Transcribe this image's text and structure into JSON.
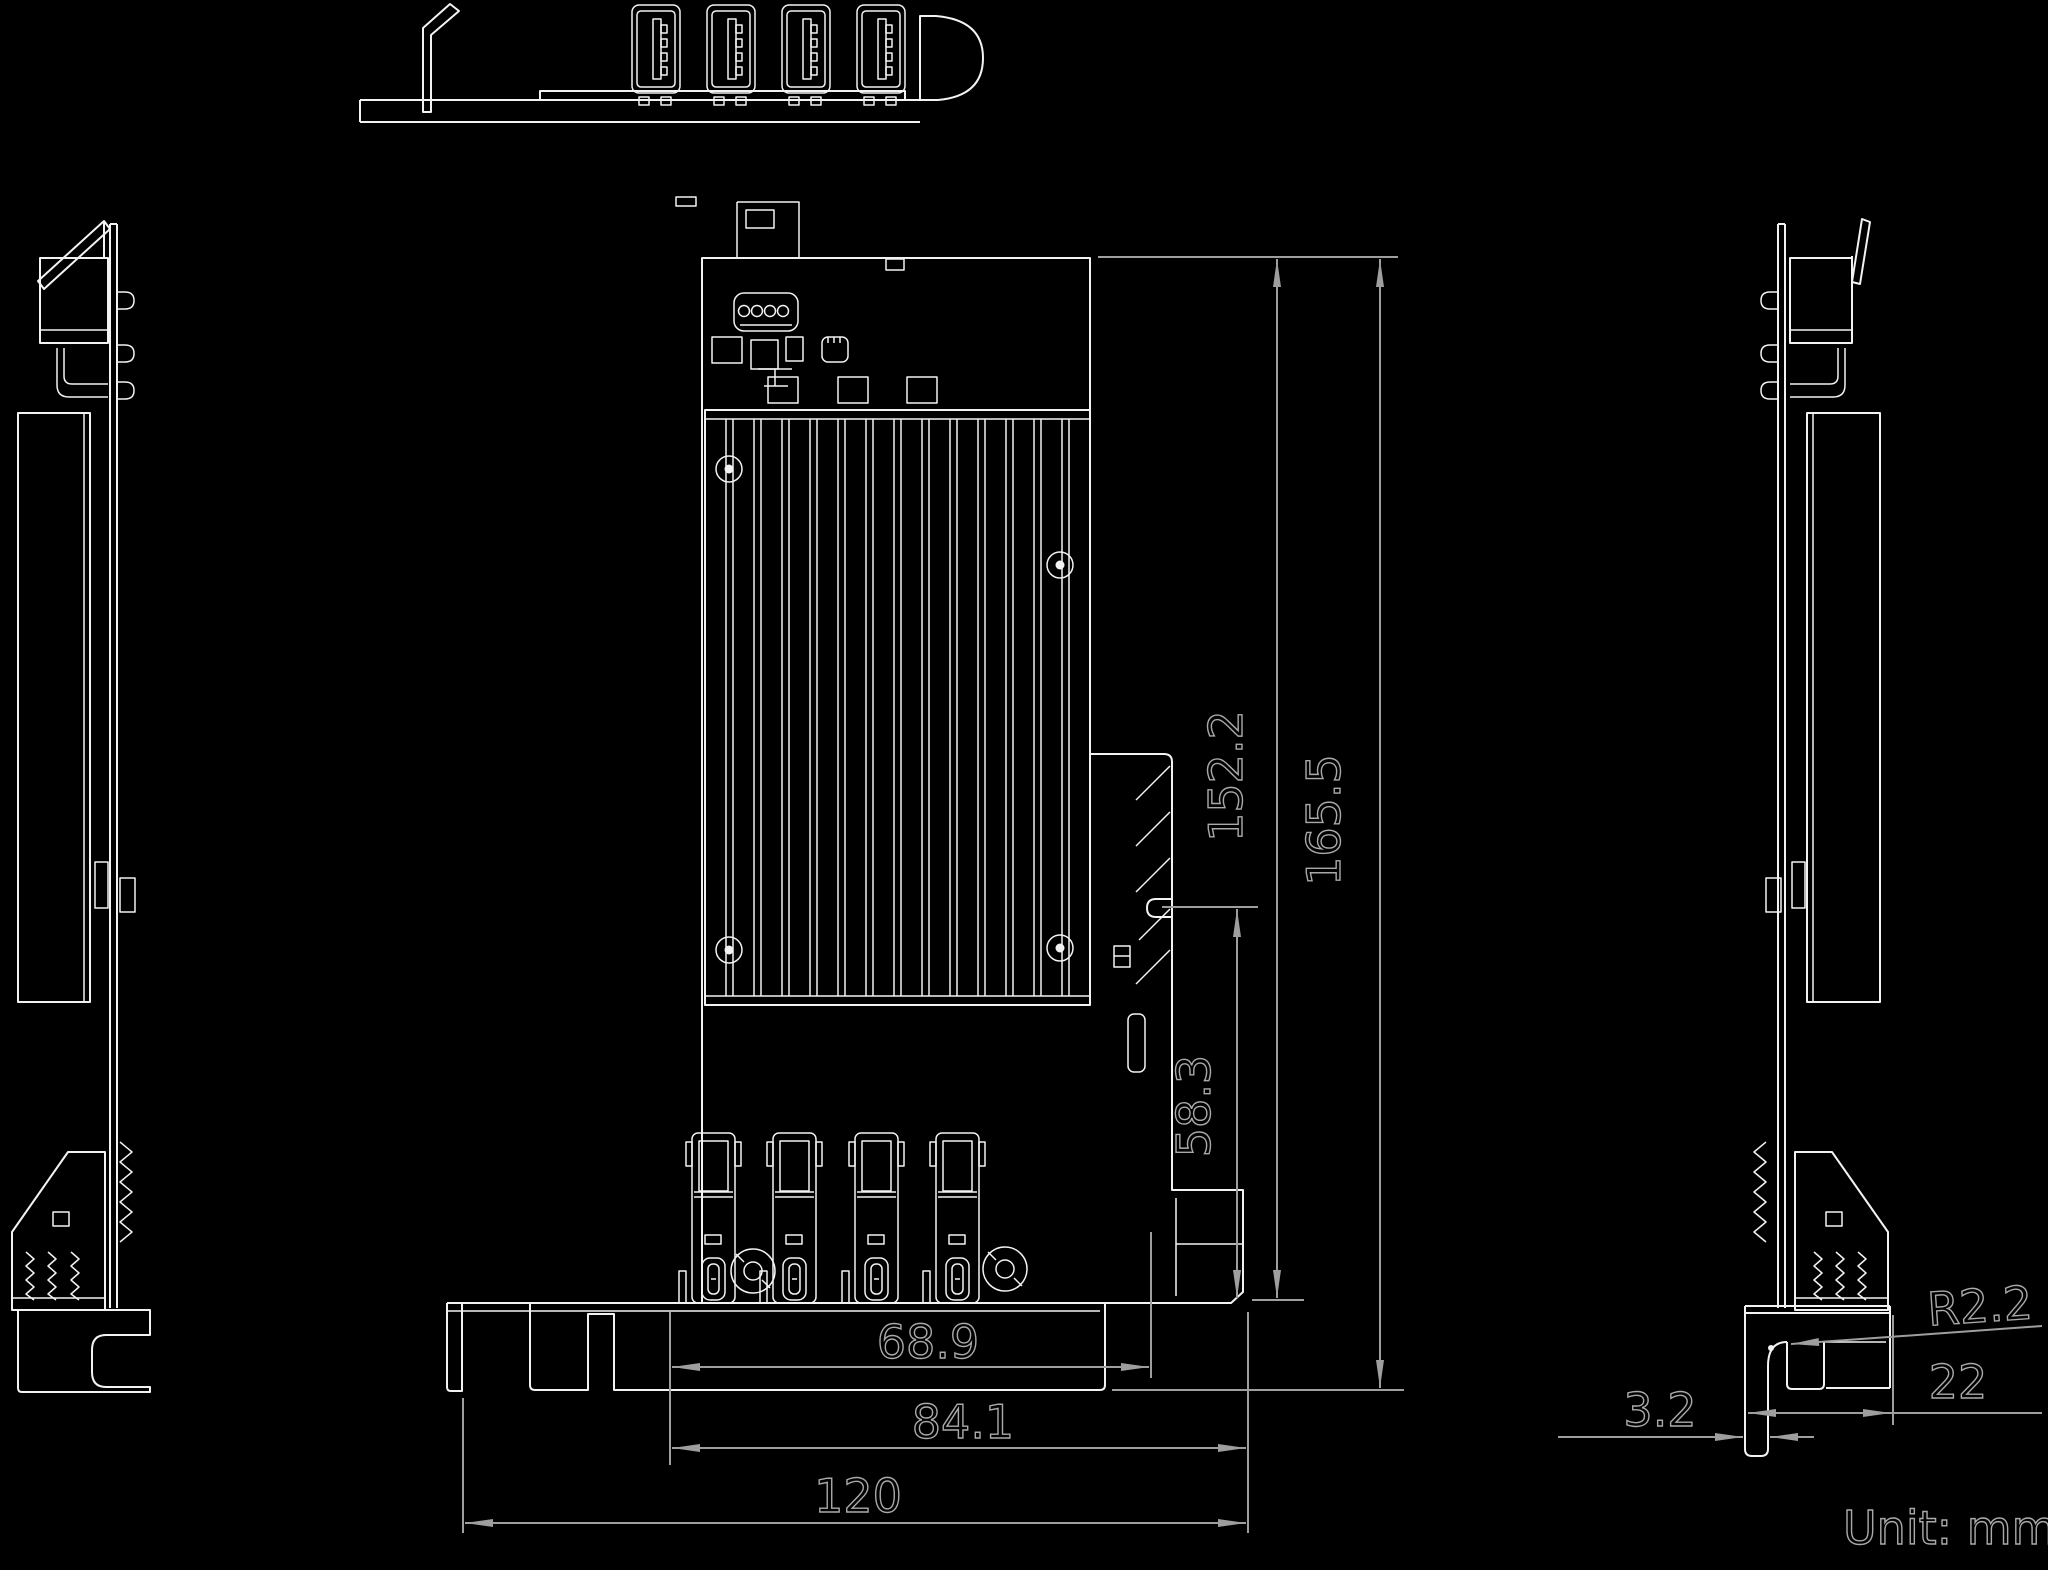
{
  "drawing": {
    "unit_label": "Unit: mm",
    "dimensions": {
      "pcb_height": "152.2",
      "overall_height": "165.5",
      "connector_zone_height": "58.3",
      "port_span_width": "68.9",
      "pcb_width": "84.1",
      "overall_width": "120",
      "bracket_corner_radius": "R2.2",
      "bracket_foot_length": "22",
      "bracket_foot_offset": "3.2"
    },
    "colors": {
      "background": "#000000",
      "geometry_line": "#f2f2f2",
      "dimension_line": "#9e9e9e"
    }
  }
}
